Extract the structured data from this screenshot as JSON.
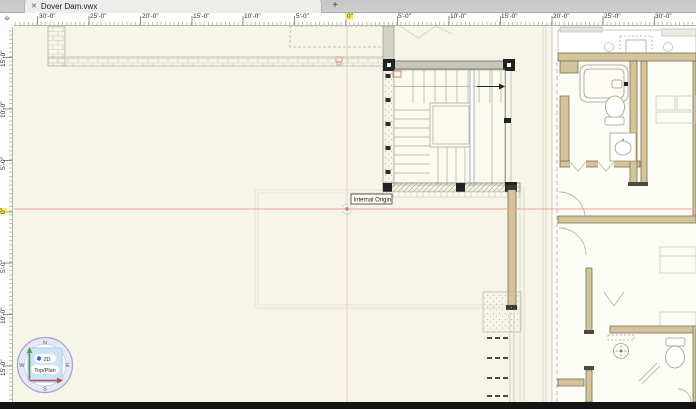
{
  "window": {
    "tab_title": "Dover Dam.vwx",
    "close_label": "✕",
    "new_tab_label": "+"
  },
  "icons": {
    "origin_crosshair": "⌖"
  },
  "rulers": {
    "horizontal_labels": [
      {
        "label": "30'-0\"",
        "x": 23,
        "hl": false
      },
      {
        "label": "25'-0\"",
        "x": 74,
        "hl": false
      },
      {
        "label": "20'-0\"",
        "x": 126,
        "hl": false
      },
      {
        "label": "15'-0\"",
        "x": 177,
        "hl": false
      },
      {
        "label": "10'-0\"",
        "x": 228,
        "hl": false
      },
      {
        "label": "5'-0\"",
        "x": 280,
        "hl": false
      },
      {
        "label": "0\"",
        "x": 331,
        "hl": true
      },
      {
        "label": "5'-0\"",
        "x": 382,
        "hl": false
      },
      {
        "label": "10'-0\"",
        "x": 434,
        "hl": false
      },
      {
        "label": "15'-0\"",
        "x": 485,
        "hl": false
      },
      {
        "label": "20'-0\"",
        "x": 537,
        "hl": false
      },
      {
        "label": "25'-0\"",
        "x": 588,
        "hl": false
      },
      {
        "label": "30'-0\"",
        "x": 639,
        "hl": false
      }
    ],
    "vertical_labels": [
      {
        "label": "15'-0\"",
        "y": 41,
        "hl": false
      },
      {
        "label": "10'-0\"",
        "y": 92,
        "hl": false
      },
      {
        "label": "5'-0\"",
        "y": 144,
        "hl": false
      },
      {
        "label": "0\"",
        "y": 188,
        "hl": true
      },
      {
        "label": "5'-0\"",
        "y": 247,
        "hl": false
      },
      {
        "label": "10'-0\"",
        "y": 298,
        "hl": false
      },
      {
        "label": "15'-0\"",
        "y": 350,
        "hl": false
      }
    ]
  },
  "canvas": {
    "origin_label": "Internal Origin"
  },
  "view_compass": {
    "north": "N",
    "east": "E",
    "south": "S",
    "west": "W",
    "mode": "2D",
    "view": "Top/Plan"
  },
  "colors": {
    "canvas_bg": "#f6f5e8",
    "origin_line_red": "#f0a396",
    "wall_tan": "#d3c49c",
    "wall_outline": "#7d6f4a",
    "highlight_yellow": "#f8ea67"
  }
}
